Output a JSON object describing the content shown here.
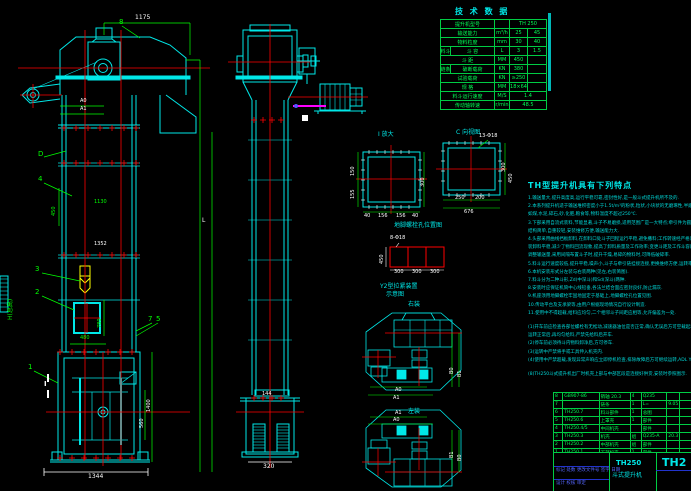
{
  "colors": {
    "outline": "#00ffff",
    "dimension": "#00ff00",
    "centerline": "#ff0000",
    "text": "#ffffff",
    "accent_magenta": "#ff00ff",
    "bucket_yellow": "#ffff00",
    "title_blue": "#5566ff"
  },
  "main_view": {
    "d1175": "1175",
    "dA0": "A0",
    "dA1": "A1",
    "p8": "8",
    "pD": "D",
    "p4": "4",
    "p3": "3",
    "p2": "2",
    "p7": "7",
    "p5": "5",
    "p1": "1",
    "secI": "I",
    "dH": "H(总高)",
    "d450": "450",
    "d1130": "1130",
    "d1352": "1352",
    "d480": "480",
    "d780": "780",
    "d1344": "1344",
    "d1400": "1400",
    "d560": "560",
    "dL": "L"
  },
  "side_view": {
    "d144": "144",
    "d320": "320"
  },
  "tech_table": {
    "title": "技 术 数 据",
    "group1": "料斗",
    "group2": "链条",
    "rows": [
      {
        "label": "提升机型号",
        "unit": "",
        "v1": "TH 250",
        "v2": "",
        "span": true,
        "g": ""
      },
      {
        "label": "输送能力",
        "unit": "m³/h",
        "v1": "25",
        "v2": "45",
        "span": false,
        "g": ""
      },
      {
        "label": "物料粒度",
        "unit": "mm",
        "v1": "30",
        "v2": "40",
        "span": false,
        "g": ""
      },
      {
        "label": "斗 容",
        "unit": "L",
        "v1": "3",
        "v2": "1.5",
        "span": false,
        "g": "料斗"
      },
      {
        "label": "斗 距",
        "unit": "MM",
        "v1": "450",
        "v2": "",
        "span": false,
        "g": ""
      },
      {
        "label": "破断载荷",
        "unit": "KN",
        "v1": "380",
        "v2": "",
        "span": false,
        "g": "链条"
      },
      {
        "label": "试验载荷",
        "unit": "KN",
        "v1": "≥250",
        "v2": "",
        "span": false,
        "g": ""
      },
      {
        "label": "规 格",
        "unit": "MM",
        "v1": "18×64",
        "v2": "",
        "span": false,
        "g": ""
      },
      {
        "label": "料斗运行速度",
        "unit": "M/S",
        "v1": "1.4",
        "v2": "",
        "span": true,
        "g": ""
      },
      {
        "label": "传动轴转速",
        "unit": "r/min",
        "v1": "48.5",
        "v2": "",
        "span": true,
        "g": ""
      }
    ]
  },
  "details": {
    "flange_left": {
      "caption": "I 放大",
      "d150": "150",
      "d155": "155",
      "d300": "300",
      "b1": "40",
      "b2": "156",
      "b3": "156",
      "b4": "40"
    },
    "flange_right": {
      "caption": "C 向视图",
      "holes": "13-Φ18",
      "d250": "250",
      "d200": "200",
      "d676": "676",
      "d300": "300",
      "d450": "450"
    },
    "anchor": {
      "caption": "地脚螺栓孔位置图",
      "holes": "8-Φ18",
      "c1": "300",
      "c2": "300",
      "c3": "300",
      "side": "450"
    },
    "tension": {
      "line1": "Y2型拉紧装置",
      "line2": "示意图"
    },
    "arrangement": {
      "top": "右装",
      "bottom": "左装",
      "dA0": "A0",
      "dA1": "A1",
      "dB0": "B0",
      "dB1": "B1"
    }
  },
  "notes": {
    "title": "TH型提升机具有下列特点",
    "lines": [
      "1.输送量大,提升高度高,运行平稳可靠,密封性好,是一般斗式提升机所不及的.",
      "2.本系列提升机适于输送堆积密度小于1.5t/m³的粉状,粒状,小块状的无磨琢性,半磨琢性散状物料,",
      "  如煤,水泥,碎石,砂,化肥,粮食等,物料温度不超过250℃.",
      "3.下部采用自流式装料,节能显著,斗子不易磨损,适用范围广是一大特点;牵引件为圆环链,工作可靠,",
      "  结构简单,自重较轻,安装维修方便,输送能力大.",
      "4.头部采用曲线挡板卸料,在卸料口处斗子回程运行平稳,避免撒料;工作转速经严格计算与实际考核,",
      "  装卸料平稳,减少了物料回流现象,提高了卸料质量及工作效率;变更斗距及工作斗容即可方便地",
      "  调整输送量,采用间隔布置斗子时,提升干燥,易碎的物料时,可降低破碎率.",
      "5.料斗运行速度较低,提升平稳,噪声小,斗子与牵引链挂接连接,更换维修方便,运转率高.",
      "6.本机安装形式分左装与右装两种(见左,右装简图).",
      "7.料斗分为二种斗形,Zd(中深斗)和Sd(深斗)两种.",
      "8.安装时应保证机筒中心线铅垂,各法兰结合面应密封良好,防止漏灰.",
      "9.机座须用地脚螺栓牢固地固定于基础上,地脚螺栓孔位置见图.",
      "10.传动平台及支承梁等,由用户根据现场情况自行设计制造.",
      "11.使用中不得超载,给料应均匀,二个相邻斗子间距应相等,允许偏差为一处.",
      "",
      "(1)开车前应检查各部位螺栓有无松动,减速器油位是否正常,确认无误后方可空载起动,",
      "  运转正常后,再均匀给料,严禁先给料后开车.",
      "(2)停车前必须待斗内物料卸净后,方可停车.",
      "(3)运转中严禁将手或工具伸入机壳内.",
      "(4)使用中严禁超载,发现异常声响应立即停机检查,排除故障后方可继续运转,ADL Y系统.",
      "",
      "(8)TH250斗式提升机出厂时机壳上部与中部区段是连接好供货,安装时参照图示."
    ]
  },
  "bom": {
    "rows": [
      {
        "no": "8",
        "code": "GB907-86",
        "name": "销轴 20.3",
        "qty": "4",
        "mat": "Q235",
        "wt": ""
      },
      {
        "no": "7",
        "code": "",
        "name": "链条",
        "qty": "1",
        "mat": "L=",
        "wt": "9.05"
      },
      {
        "no": "6",
        "code": "TH250.7",
        "name": "料斗部件",
        "qty": "1",
        "mat": "总图",
        "wt": ""
      },
      {
        "no": "5",
        "code": "TH250.6",
        "name": "上罩壳",
        "qty": "1",
        "mat": "部件",
        "wt": ""
      },
      {
        "no": "4",
        "code": "TH250.4/5",
        "name": "中间机壳",
        "qty": "",
        "mat": "部件",
        "wt": ""
      },
      {
        "no": "3",
        "code": "TH250.3",
        "name": "机壳",
        "qty": "组",
        "mat": "Q235-A",
        "wt": "20.3"
      },
      {
        "no": "2",
        "code": "TH250.2",
        "name": "中部机壳",
        "qty": "组",
        "mat": "部件",
        "wt": ""
      },
      {
        "no": "1",
        "code": "TH250.1",
        "name": "下部机壳",
        "qty": "1",
        "mat": "部件",
        "wt": ""
      }
    ],
    "footer": [
      "件号",
      "代  号",
      "名  称",
      "数量",
      "材  料",
      "重量",
      "备注"
    ]
  },
  "title_block": {
    "model": "TH250",
    "product": "斗式提升机",
    "partial": "TH2",
    "row1": "标记 处数 更改文件号 签字 日期",
    "row2": "设计  校核  审定"
  }
}
